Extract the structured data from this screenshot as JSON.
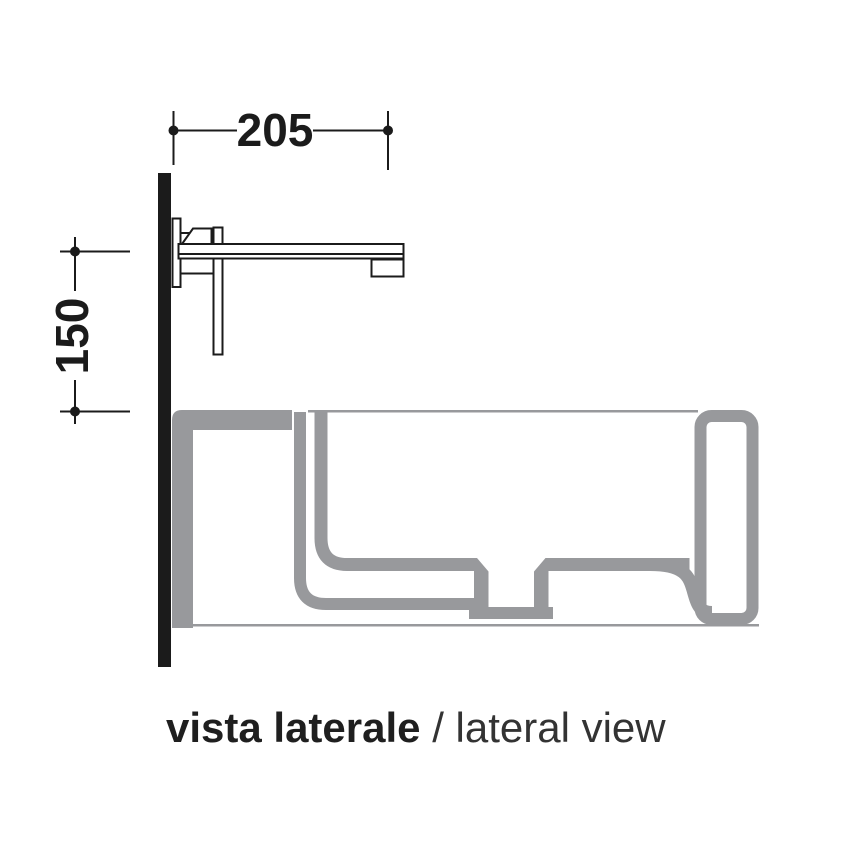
{
  "dimensions": {
    "spout_projection_mm": "205",
    "mounting_height_mm": "150"
  },
  "caption": {
    "italian": "vista laterale",
    "separator": " / ",
    "english": "lateral view"
  },
  "colors": {
    "line_black": "#1b1b1b",
    "ceramic_gray": "#98999c",
    "caption_dark": "#242424",
    "background": "#ffffff"
  },
  "view": {
    "type": "lateral-section",
    "subject": "wall-mounted-basin-mixer-over-washbasin"
  }
}
